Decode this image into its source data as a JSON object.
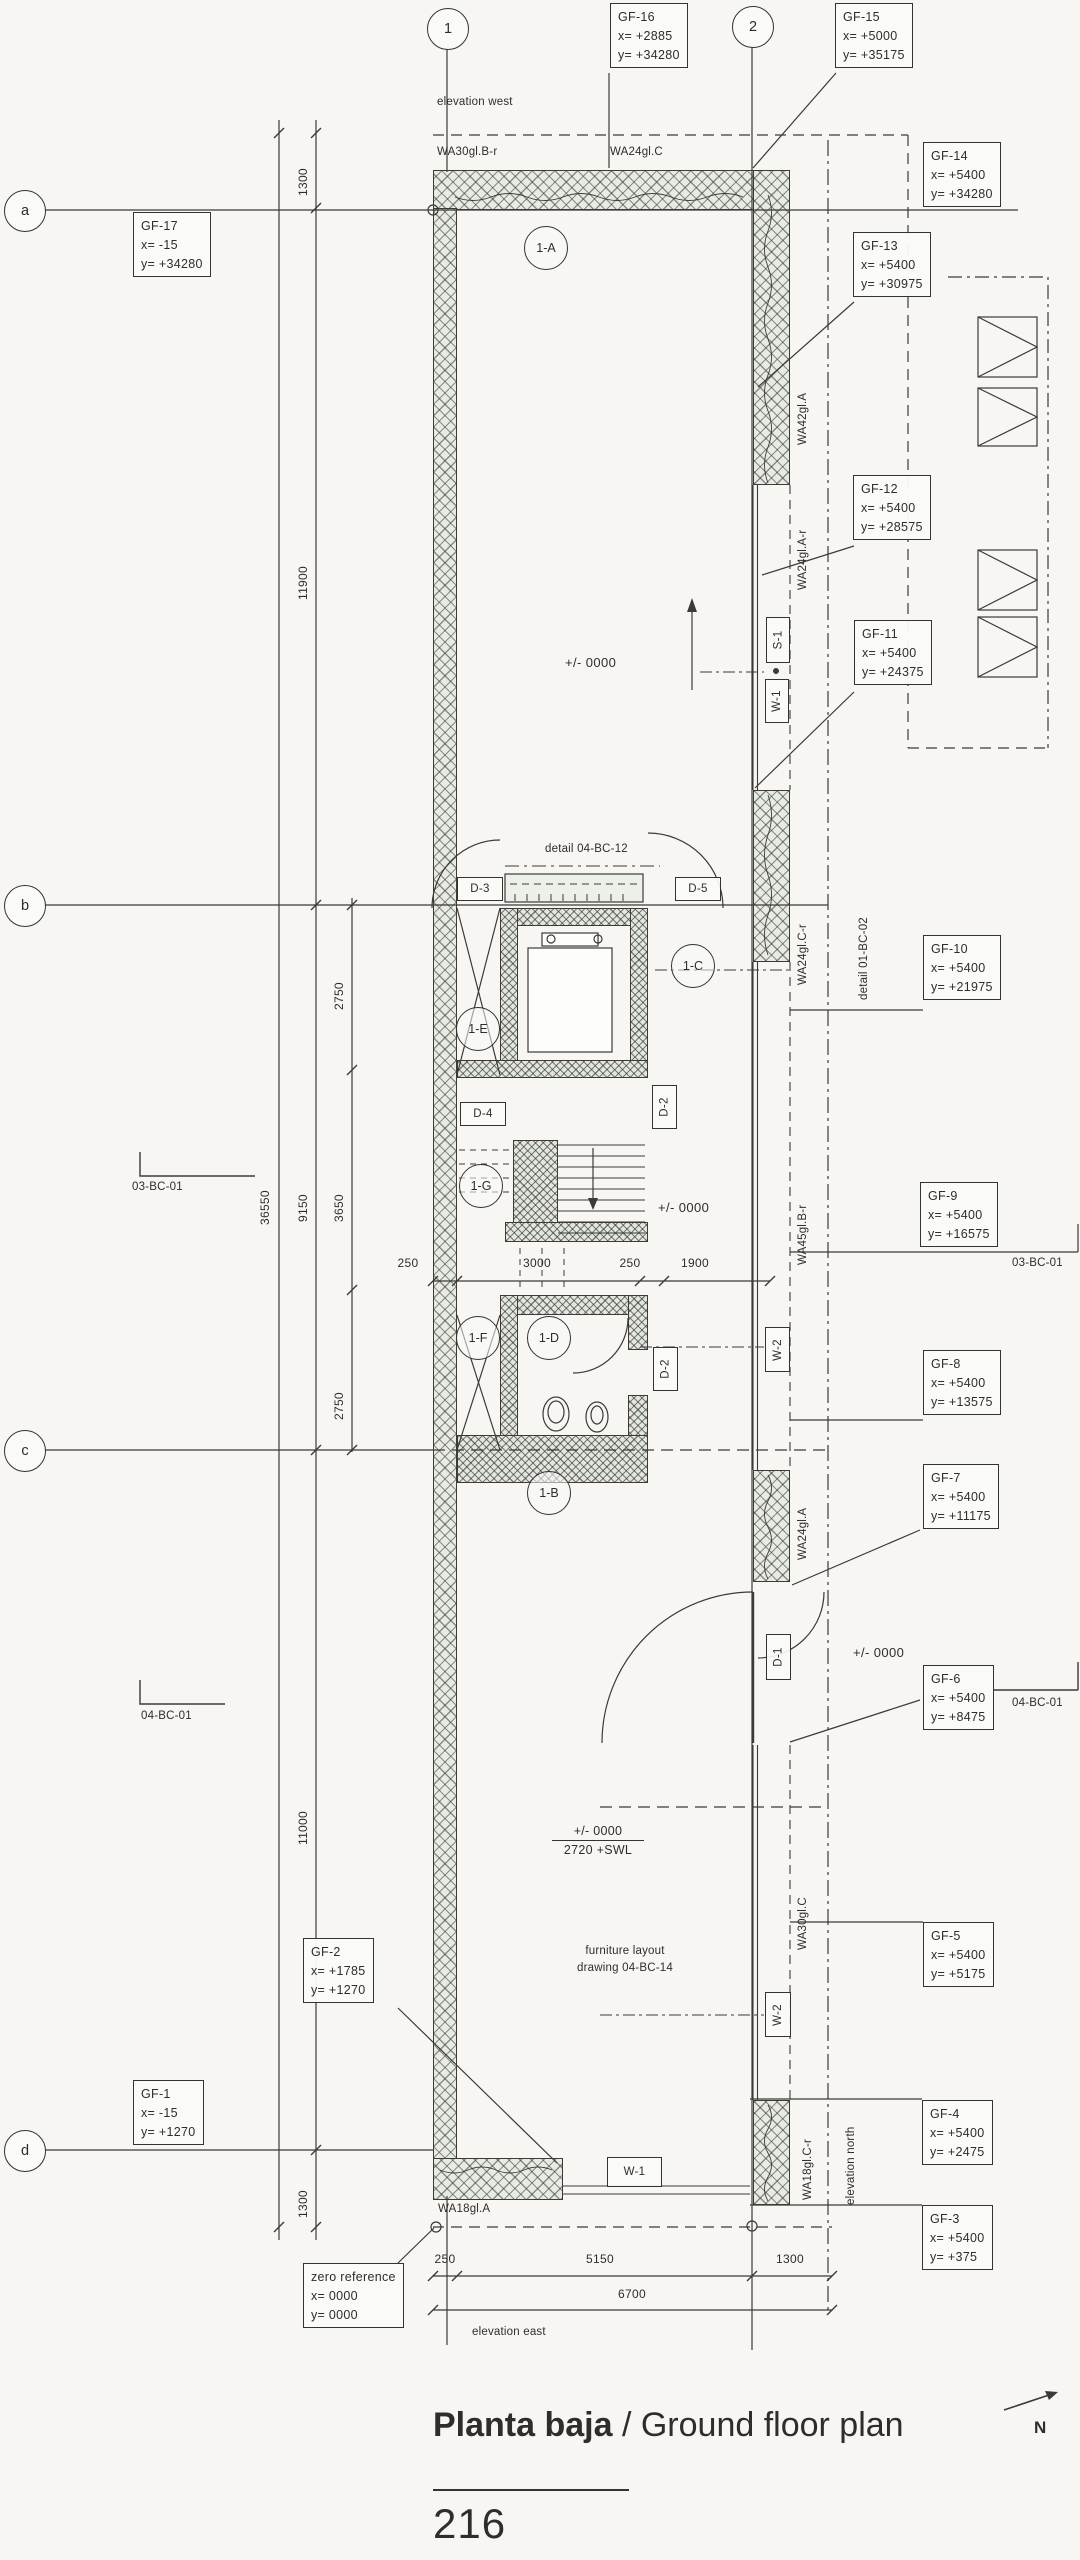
{
  "title": {
    "main": "Planta baja",
    "separator": " / ",
    "sub": "Ground floor plan"
  },
  "page_number": "216",
  "north_label": "N",
  "grid_bubbles": [
    {
      "id": "1",
      "t": "1",
      "x": 447,
      "y": 28
    },
    {
      "id": "2",
      "t": "2",
      "x": 752,
      "y": 26
    },
    {
      "id": "a",
      "t": "a",
      "x": 24,
      "y": 210
    },
    {
      "id": "b",
      "t": "b",
      "x": 24,
      "y": 905
    },
    {
      "id": "c",
      "t": "c",
      "x": 24,
      "y": 1450
    },
    {
      "id": "d",
      "t": "d",
      "x": 24,
      "y": 2150
    }
  ],
  "coord_markers": [
    {
      "id": "GF-17",
      "lines": [
        "GF-17",
        "x= -15",
        "y= +34280"
      ],
      "px": 133,
      "py": 212
    },
    {
      "id": "GF-16",
      "lines": [
        "GF-16",
        "x= +2885",
        "y= +34280"
      ],
      "px": 610,
      "py": 3
    },
    {
      "id": "GF-15",
      "lines": [
        "GF-15",
        "x= +5000",
        "y= +35175"
      ],
      "px": 835,
      "py": 3
    },
    {
      "id": "GF-14",
      "lines": [
        "GF-14",
        "x= +5400",
        "y= +34280"
      ],
      "px": 923,
      "py": 142
    },
    {
      "id": "GF-13",
      "lines": [
        "GF-13",
        "x= +5400",
        "y= +30975"
      ],
      "px": 853,
      "py": 232
    },
    {
      "id": "GF-12",
      "lines": [
        "GF-12",
        "x= +5400",
        "y= +28575"
      ],
      "px": 853,
      "py": 475
    },
    {
      "id": "GF-11",
      "lines": [
        "GF-11",
        "x= +5400",
        "y= +24375"
      ],
      "px": 854,
      "py": 620
    },
    {
      "id": "GF-10",
      "lines": [
        "GF-10",
        "x= +5400",
        "y= +21975"
      ],
      "px": 923,
      "py": 935
    },
    {
      "id": "GF-9",
      "lines": [
        "GF-9",
        "x= +5400",
        "y= +16575"
      ],
      "px": 920,
      "py": 1182
    },
    {
      "id": "GF-8",
      "lines": [
        "GF-8",
        "x= +5400",
        "y= +13575"
      ],
      "px": 923,
      "py": 1350
    },
    {
      "id": "GF-7",
      "lines": [
        "GF-7",
        "x= +5400",
        "y= +11175"
      ],
      "px": 923,
      "py": 1464
    },
    {
      "id": "GF-6",
      "lines": [
        "GF-6",
        "x= +5400",
        "y= +8475"
      ],
      "px": 923,
      "py": 1665
    },
    {
      "id": "GF-5",
      "lines": [
        "GF-5",
        "x= +5400",
        "y= +5175"
      ],
      "px": 923,
      "py": 1922
    },
    {
      "id": "GF-4",
      "lines": [
        "GF-4",
        "x= +5400",
        "y= +2475"
      ],
      "px": 922,
      "py": 2100
    },
    {
      "id": "GF-3",
      "lines": [
        "GF-3",
        "x= +5400",
        "y= +375"
      ],
      "px": 922,
      "py": 2205
    },
    {
      "id": "GF-2",
      "lines": [
        "GF-2",
        "x= +1785",
        "y= +1270"
      ],
      "px": 303,
      "py": 1938
    },
    {
      "id": "GF-1",
      "lines": [
        "GF-1",
        "x= -15",
        "y= +1270"
      ],
      "px": 133,
      "py": 2080
    }
  ],
  "zero_reference": {
    "lines": [
      "zero reference",
      "x= 0000",
      "y= 0000"
    ],
    "px": 303,
    "py": 2263
  },
  "room_tags": [
    {
      "t": "1-A",
      "x": 545,
      "y": 247
    },
    {
      "t": "1-B",
      "x": 548,
      "y": 1492
    },
    {
      "t": "1-C",
      "x": 692,
      "y": 965
    },
    {
      "t": "1-D",
      "x": 548,
      "y": 1337
    },
    {
      "t": "1-E",
      "x": 477,
      "y": 1028
    },
    {
      "t": "1-F",
      "x": 477,
      "y": 1337
    },
    {
      "t": "1-G",
      "x": 480,
      "y": 1185
    }
  ],
  "opening_tags": [
    {
      "t": "D-3",
      "x": 457,
      "y": 877,
      "w": 44,
      "h": 22,
      "rot": false
    },
    {
      "t": "D-5",
      "x": 675,
      "y": 877,
      "w": 44,
      "h": 22,
      "rot": false
    },
    {
      "t": "D-4",
      "x": 460,
      "y": 1102,
      "w": 44,
      "h": 22,
      "rot": false
    },
    {
      "t": "D-2",
      "x": 652,
      "y": 1085,
      "w": 23,
      "h": 42,
      "rot": true
    },
    {
      "t": "D-2",
      "x": 653,
      "y": 1347,
      "w": 23,
      "h": 42,
      "rot": true
    },
    {
      "t": "D-1",
      "x": 766,
      "y": 1634,
      "w": 23,
      "h": 44,
      "rot": true
    },
    {
      "t": "S-1",
      "x": 766,
      "y": 617,
      "w": 22,
      "h": 44,
      "rot": true
    },
    {
      "t": "W-1",
      "x": 765,
      "y": 679,
      "w": 22,
      "h": 42,
      "rot": true
    },
    {
      "t": "W-2",
      "x": 765,
      "y": 1327,
      "w": 23,
      "h": 43,
      "rot": true
    },
    {
      "t": "W-2",
      "x": 765,
      "y": 1992,
      "w": 24,
      "h": 43,
      "rot": true
    },
    {
      "t": "W-1",
      "x": 607,
      "y": 2157,
      "w": 53,
      "h": 28,
      "rot": false
    }
  ],
  "wall_tags": [
    {
      "t": "WA30gl.B-r",
      "x": 437,
      "y": 146,
      "rot": false
    },
    {
      "t": "WA24gl.C",
      "x": 610,
      "y": 146,
      "rot": false
    },
    {
      "t": "WA42gl.A",
      "x": 797,
      "y": 445,
      "rot": true
    },
    {
      "t": "WA24gl.A-r",
      "x": 797,
      "y": 590,
      "rot": true
    },
    {
      "t": "WA24gl.C-r",
      "x": 797,
      "y": 985,
      "rot": true
    },
    {
      "t": "WA45gl.B-r",
      "x": 797,
      "y": 1265,
      "rot": true
    },
    {
      "t": "WA24gl.A",
      "x": 797,
      "y": 1560,
      "rot": true
    },
    {
      "t": "WA30gl.C",
      "x": 797,
      "y": 1950,
      "rot": true
    },
    {
      "t": "WA18gl.C-r",
      "x": 802,
      "y": 2200,
      "rot": true
    },
    {
      "t": "WA18gl.A",
      "x": 438,
      "y": 2203,
      "rot": false
    }
  ],
  "notes": [
    {
      "t": "elevation west",
      "x": 437,
      "y": 96,
      "rot": false
    },
    {
      "t": "elevation east",
      "x": 472,
      "y": 2326,
      "rot": false
    },
    {
      "t": "elevation north",
      "x": 845,
      "y": 2205,
      "rot": true
    },
    {
      "t": "detail 04-BC-12",
      "x": 545,
      "y": 843,
      "rot": false
    },
    {
      "t": "detail 01-BC-02",
      "x": 858,
      "y": 1000,
      "rot": true
    },
    {
      "t": "furniture layout",
      "x": 560,
      "y": 1945,
      "rot": false,
      "w": 130,
      "center": true
    },
    {
      "t": "drawing 04-BC-14",
      "x": 560,
      "y": 1962,
      "rot": false,
      "w": 130,
      "center": true
    },
    {
      "t": "03-BC-01",
      "x": 132,
      "y": 1181,
      "rot": false
    },
    {
      "t": "03-BC-01",
      "x": 1012,
      "y": 1257,
      "rot": false
    },
    {
      "t": "04-BC-01",
      "x": 141,
      "y": 1710,
      "rot": false
    },
    {
      "t": "04-BC-01",
      "x": 1012,
      "y": 1697,
      "rot": false
    }
  ],
  "dimensions": [
    {
      "t": "1300",
      "x": 296,
      "y": 196,
      "rot": true
    },
    {
      "t": "11900",
      "x": 296,
      "y": 600,
      "rot": true
    },
    {
      "t": "36550",
      "x": 258,
      "y": 1225,
      "rot": true
    },
    {
      "t": "9150",
      "x": 296,
      "y": 1222,
      "rot": true
    },
    {
      "t": "2750",
      "x": 332,
      "y": 1010,
      "rot": true
    },
    {
      "t": "3650",
      "x": 332,
      "y": 1222,
      "rot": true
    },
    {
      "t": "2750",
      "x": 332,
      "y": 1420,
      "rot": true
    },
    {
      "t": "11000",
      "x": 296,
      "y": 1845,
      "rot": true
    },
    {
      "t": "1300",
      "x": 296,
      "y": 2218,
      "rot": true
    },
    {
      "t": "250",
      "x": 408,
      "y": 1256,
      "rot": false
    },
    {
      "t": "3000",
      "x": 537,
      "y": 1256,
      "rot": false
    },
    {
      "t": "250",
      "x": 630,
      "y": 1256,
      "rot": false
    },
    {
      "t": "1900",
      "x": 695,
      "y": 1256,
      "rot": false
    },
    {
      "t": "250",
      "x": 445,
      "y": 2252,
      "rot": false
    },
    {
      "t": "5150",
      "x": 600,
      "y": 2252,
      "rot": false
    },
    {
      "t": "1300",
      "x": 790,
      "y": 2252,
      "rot": false
    },
    {
      "t": "6700",
      "x": 632,
      "y": 2287,
      "rot": false
    }
  ],
  "levels": [
    {
      "t": "+/- 0000",
      "x": 565,
      "y": 655
    },
    {
      "t": "+/- 0000",
      "x": 658,
      "y": 1200
    },
    {
      "t": "+/- 0000",
      "x": 853,
      "y": 1645
    }
  ],
  "level_marker": {
    "top": "+/- 0000",
    "bottom": "2720 +SWL"
  }
}
